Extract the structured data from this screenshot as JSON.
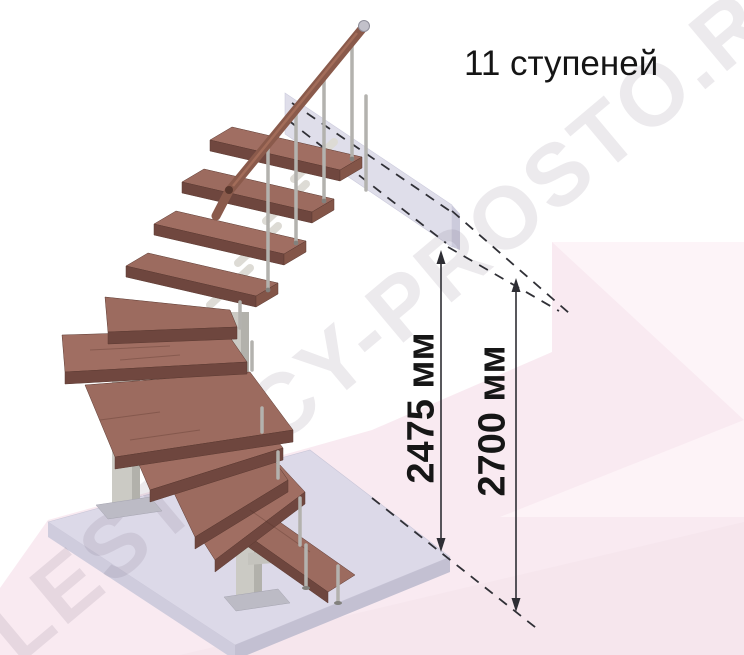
{
  "title": "11 ступеней",
  "watermark": "LESTNICY-PROSTO.RU",
  "dimensions": {
    "inner_height_label": "2475 мм",
    "total_height_label": "2700 мм"
  },
  "illustration": {
    "steps_count": 11,
    "colors": {
      "tread_wood_top": "#9c6b5f",
      "tread_wood_front": "#6e463e",
      "handrail_wood": "#8a5a4b",
      "metal_post": "#cbcac4",
      "baluster_steel": "#b3b2ae",
      "floor_slab": "#dcd9e8",
      "upper_floor_beam": "#dddce9",
      "background_pink": "#f9eaf1",
      "dimension_line": "#2e2e34"
    }
  }
}
